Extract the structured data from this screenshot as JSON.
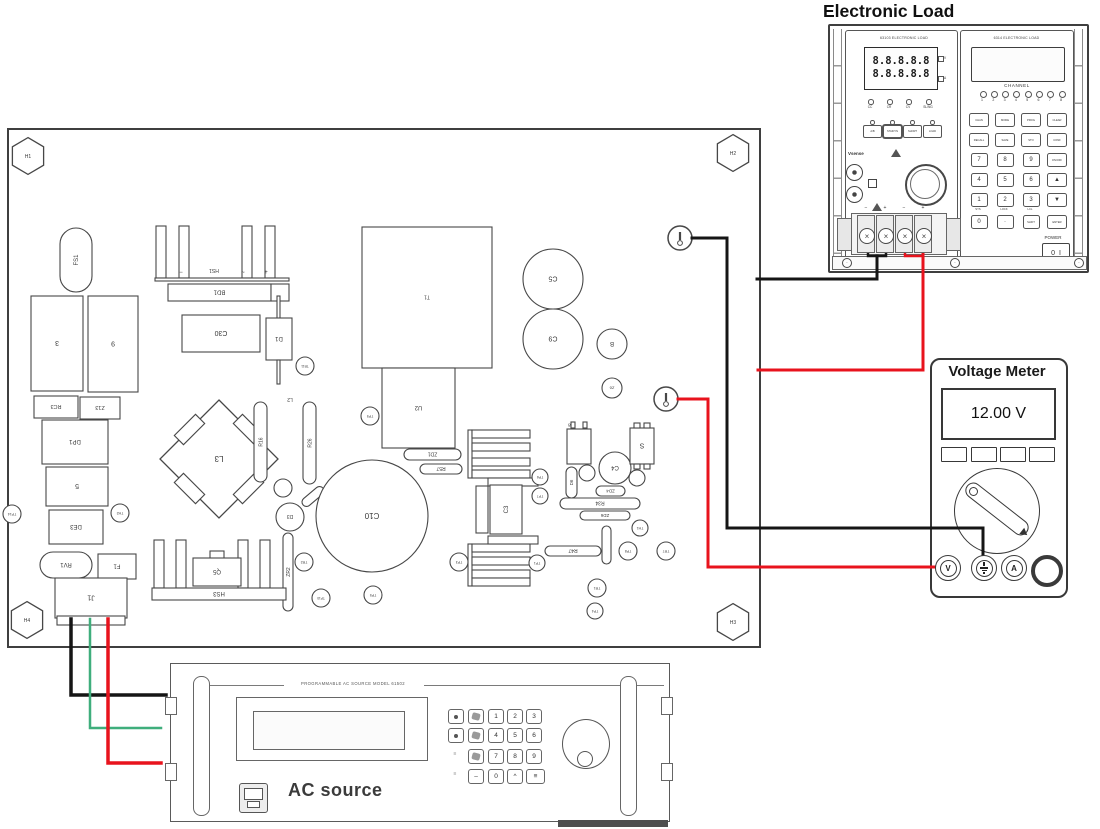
{
  "titles": {
    "electronic_load": "Electronic Load",
    "voltage_meter": "Voltage Meter",
    "ac_source_label": "AC source",
    "ac_source_header": "PROGRAMMABLE AC SOURCE MODEL 61502"
  },
  "load": {
    "left_module_title": "63103 ELECTRONIC LOAD",
    "right_module_title": "6314 ELECTRONIC LOAD",
    "display_rows": [
      "8.8.8.8.8",
      "8.8.8.8.8"
    ],
    "display_units": [
      "V",
      "A"
    ],
    "indicators": [
      "CC",
      "CR",
      "CV",
      "SL/NG"
    ],
    "mode_buttons": [
      "A/B",
      "STA/DYN",
      "SHORT",
      "LOAD"
    ],
    "vsense_label": "Vsense",
    "channel_label": "CHANNEL",
    "channels": [
      "1",
      "2",
      "3",
      "4",
      "5",
      "6",
      "7",
      "8"
    ],
    "keypad": [
      [
        "CHAN",
        "MODE",
        "PROG",
        "CLEAR"
      ],
      [
        "RECALL",
        "SAVE",
        "STO",
        "CONF"
      ],
      [
        "7",
        "8",
        "9",
        "ON/OFF"
      ],
      [
        "4",
        "5",
        "6",
        "▲"
      ],
      [
        "1",
        "2",
        "3",
        "▼"
      ],
      [
        "0",
        "·",
        "SHIFT",
        "ENTER"
      ]
    ],
    "keypad_sublabels": [
      "SYS",
      "LOCK",
      "LCL"
    ],
    "power_label": "POWER",
    "power_switch_off": "0",
    "power_switch_on": "I",
    "terminal_marks": [
      "−",
      "+",
      "−",
      "+"
    ]
  },
  "meter": {
    "reading": "12.00 V",
    "jacks": [
      "V",
      "gnd",
      "A",
      ""
    ]
  },
  "ac": {
    "keypad": [
      [
        "knob",
        "icon",
        "1",
        "2",
        "3"
      ],
      [
        "knob",
        "icon",
        "4",
        "5",
        "6"
      ],
      [
        "mark",
        "fill",
        "7",
        "8",
        "9"
      ],
      [
        "mark",
        "dash",
        "0",
        "caret",
        "wide"
      ]
    ]
  },
  "pcb": {
    "board": {
      "x": 8,
      "y": 129,
      "w": 752,
      "h": 518
    },
    "hexes": [
      {
        "x": 28,
        "y": 156,
        "rad": 18,
        "l": "H1"
      },
      {
        "x": 733,
        "y": 153,
        "rad": 18,
        "l": "H2"
      },
      {
        "x": 733,
        "y": 622,
        "rad": 18,
        "l": "H3"
      },
      {
        "x": 27,
        "y": 620,
        "rad": 18,
        "l": "H4"
      }
    ],
    "components": [
      {
        "t": "pill",
        "x": 60,
        "y": 228,
        "w": 32,
        "h": 64,
        "l": "FS1",
        "r": 270,
        "fs": 6
      },
      {
        "t": "rect",
        "x": 31,
        "y": 296,
        "w": 52,
        "h": 95,
        "l": "3",
        "r": 180,
        "fs": 7
      },
      {
        "t": "rect",
        "x": 88,
        "y": 296,
        "w": 50,
        "h": 96,
        "l": "9",
        "r": 180,
        "fs": 7
      },
      {
        "t": "rect",
        "x": 34,
        "y": 396,
        "w": 44,
        "h": 22,
        "l": "RC3",
        "r": 180,
        "fs": 5.5
      },
      {
        "t": "rect",
        "x": 80,
        "y": 397,
        "w": 40,
        "h": 22,
        "l": "Z13",
        "r": 180,
        "fs": 5.5
      },
      {
        "t": "rect",
        "x": 42,
        "y": 420,
        "w": 66,
        "h": 44,
        "l": "DP1",
        "r": 180,
        "fs": 6
      },
      {
        "t": "rect",
        "x": 46,
        "y": 467,
        "w": 62,
        "h": 39,
        "l": "5",
        "r": 180,
        "fs": 7
      },
      {
        "t": "rect",
        "x": 49,
        "y": 510,
        "w": 54,
        "h": 34,
        "l": "DE3",
        "r": 180,
        "fs": 6
      },
      {
        "t": "circle",
        "x": 12,
        "y": 514,
        "rad": 9,
        "l": "TP14",
        "r": 180,
        "fs": 3.5
      },
      {
        "t": "circle",
        "x": 120,
        "y": 513,
        "rad": 9,
        "l": "TH2",
        "r": 180,
        "fs": 3.5
      },
      {
        "t": "pill",
        "x": 40,
        "y": 552,
        "w": 52,
        "h": 26,
        "l": "RV1",
        "r": 180,
        "fs": 6
      },
      {
        "t": "rect",
        "x": 98,
        "y": 554,
        "w": 38,
        "h": 25,
        "l": "F1",
        "r": 180,
        "fs": 6
      },
      {
        "t": "rect",
        "x": 55,
        "y": 578,
        "w": 72,
        "h": 40,
        "l": "J1",
        "r": 180,
        "fs": 7
      },
      {
        "t": "rect",
        "x": 57,
        "y": 616,
        "w": 68,
        "h": 9
      },
      {
        "t": "finset",
        "x": 152,
        "y": 226,
        "fw": 10,
        "fh": 52,
        "fxs": [
          4,
          27,
          90,
          113
        ]
      },
      {
        "t": "rect",
        "x": 155,
        "y": 278,
        "w": 134,
        "h": 3
      },
      {
        "t": "text",
        "x": 181,
        "y": 272,
        "l": "−",
        "fs": 6
      },
      {
        "t": "text",
        "x": 214,
        "y": 271,
        "l": "HS1",
        "r": 180,
        "fs": 5
      },
      {
        "t": "text",
        "x": 243,
        "y": 272,
        "l": "~",
        "fs": 6
      },
      {
        "t": "text",
        "x": 266,
        "y": 272,
        "l": "+",
        "fs": 6
      },
      {
        "t": "rect",
        "x": 168,
        "y": 284,
        "w": 103,
        "h": 17,
        "l": "BD1",
        "r": 180,
        "fs": 6
      },
      {
        "t": "rect",
        "x": 271,
        "y": 284,
        "w": 18,
        "h": 17
      },
      {
        "t": "rect",
        "x": 182,
        "y": 315,
        "w": 78,
        "h": 37,
        "l": "C30",
        "r": 180,
        "fs": 7
      },
      {
        "t": "rect",
        "x": 277,
        "y": 296,
        "w": 3,
        "h": 24
      },
      {
        "t": "rect",
        "x": 266,
        "y": 318,
        "w": 26,
        "h": 42,
        "l": "D1",
        "r": 180,
        "fs": 6
      },
      {
        "t": "rect",
        "x": 277,
        "y": 360,
        "w": 3,
        "h": 24
      },
      {
        "t": "circle",
        "x": 305,
        "y": 366,
        "rad": 9,
        "l": "TR11",
        "r": 180,
        "fs": 3.2
      },
      {
        "t": "rect",
        "x": 362,
        "y": 227,
        "w": 130,
        "h": 141,
        "l": "T1",
        "r": 180,
        "fs": 5
      },
      {
        "t": "rect",
        "x": 382,
        "y": 368,
        "w": 73,
        "h": 80,
        "l": "U2",
        "r": 180,
        "fs": 6
      },
      {
        "t": "circle",
        "x": 553,
        "y": 279,
        "rad": 30,
        "l": "C5",
        "r": 180,
        "fs": 7
      },
      {
        "t": "circle",
        "x": 553,
        "y": 339,
        "rad": 30,
        "l": "C9",
        "r": 180,
        "fs": 7
      },
      {
        "t": "circle",
        "x": 612,
        "y": 344,
        "rad": 15,
        "l": "B",
        "r": 180,
        "fs": 6
      },
      {
        "t": "circle",
        "x": 612,
        "y": 388,
        "rad": 10,
        "l": "Z6",
        "r": 180,
        "fs": 4
      },
      {
        "t": "tp",
        "x": 680,
        "y": 238,
        "rad": 12
      },
      {
        "t": "tp",
        "x": 666,
        "y": 399,
        "rad": 12
      },
      {
        "t": "xf",
        "x": 219,
        "y": 459,
        "s": 118,
        "l": "L3",
        "r": 180,
        "fs": 8
      },
      {
        "t": "pill",
        "x": 254,
        "y": 402,
        "w": 13,
        "h": 80,
        "l": "R16",
        "r": 270,
        "fs": 5
      },
      {
        "t": "pill",
        "x": 303,
        "y": 402,
        "w": 13,
        "h": 82,
        "l": "R26",
        "r": 270,
        "fs": 5
      },
      {
        "t": "text",
        "x": 290,
        "y": 400,
        "l": "L2",
        "r": 180,
        "fs": 5
      },
      {
        "t": "circle",
        "x": 283,
        "y": 488,
        "rad": 9
      },
      {
        "t": "circle",
        "x": 290,
        "y": 517,
        "rad": 14,
        "l": "D3",
        "r": 180,
        "fs": 5
      },
      {
        "t": "pill",
        "x": 300,
        "y": 492,
        "w": 26,
        "h": 9,
        "a": -40
      },
      {
        "t": "circle",
        "x": 372,
        "y": 516,
        "rad": 56,
        "l": "C10",
        "r": 180,
        "fs": 8
      },
      {
        "t": "pill",
        "x": 404,
        "y": 449,
        "w": 57,
        "h": 11,
        "l": "ZD1",
        "r": 180,
        "fs": 5
      },
      {
        "t": "pill",
        "x": 420,
        "y": 464,
        "w": 42,
        "h": 10,
        "l": "R57",
        "r": 180,
        "fs": 5
      },
      {
        "t": "circle",
        "x": 370,
        "y": 416,
        "rad": 9,
        "l": "TP9",
        "r": 180,
        "fs": 3.5
      },
      {
        "t": "finseth",
        "x": 468,
        "y": 430,
        "fw": 58,
        "fh": 8,
        "fys": [
          0,
          13,
          28,
          40
        ]
      },
      {
        "t": "finseth",
        "x": 468,
        "y": 544,
        "fw": 58,
        "fh": 8,
        "fys": [
          0,
          13,
          26,
          34
        ]
      },
      {
        "t": "rect",
        "x": 488,
        "y": 478,
        "w": 50,
        "h": 8
      },
      {
        "t": "rect",
        "x": 488,
        "y": 536,
        "w": 50,
        "h": 8
      },
      {
        "t": "rect",
        "x": 476,
        "y": 486,
        "w": 12,
        "h": 47
      },
      {
        "t": "rect",
        "x": 490,
        "y": 485,
        "w": 32,
        "h": 49,
        "l": "C3",
        "r": 270,
        "fs": 6
      },
      {
        "t": "rect",
        "x": 567,
        "y": 429,
        "w": 24,
        "h": 35
      },
      {
        "t": "text",
        "x": 571,
        "y": 425,
        "l": "C8",
        "r": 180,
        "fs": 4.5
      },
      {
        "t": "rect",
        "x": 571,
        "y": 422,
        "w": 4,
        "h": 6
      },
      {
        "t": "rect",
        "x": 583,
        "y": 422,
        "w": 4,
        "h": 6
      },
      {
        "t": "pill",
        "x": 566,
        "y": 467,
        "w": 11,
        "h": 31,
        "l": "D6",
        "r": 270,
        "fs": 4.5
      },
      {
        "t": "circle",
        "x": 615,
        "y": 468,
        "rad": 16,
        "l": "C4",
        "r": 180,
        "fs": 6
      },
      {
        "t": "circle",
        "x": 587,
        "y": 473,
        "rad": 8
      },
      {
        "t": "circle",
        "x": 637,
        "y": 478,
        "rad": 8
      },
      {
        "t": "rect",
        "x": 630,
        "y": 428,
        "w": 24,
        "h": 36,
        "l": "S",
        "r": 180,
        "fs": 7
      },
      {
        "t": "rect",
        "x": 634,
        "y": 423,
        "w": 6,
        "h": 5
      },
      {
        "t": "rect",
        "x": 644,
        "y": 423,
        "w": 6,
        "h": 5
      },
      {
        "t": "rect",
        "x": 634,
        "y": 464,
        "w": 6,
        "h": 5
      },
      {
        "t": "rect",
        "x": 644,
        "y": 464,
        "w": 6,
        "h": 5
      },
      {
        "t": "pill",
        "x": 596,
        "y": 486,
        "w": 29,
        "h": 10,
        "l": "ZD4",
        "r": 180,
        "fs": 4.5
      },
      {
        "t": "pill",
        "x": 560,
        "y": 498,
        "w": 80,
        "h": 11,
        "l": "R34",
        "r": 180,
        "fs": 5
      },
      {
        "t": "pill",
        "x": 580,
        "y": 511,
        "w": 50,
        "h": 9,
        "l": "ZD6",
        "r": 180,
        "fs": 4.5
      },
      {
        "t": "circle",
        "x": 640,
        "y": 528,
        "rad": 8,
        "l": "TH1",
        "r": 180,
        "fs": 3.5
      },
      {
        "t": "circle",
        "x": 628,
        "y": 551,
        "rad": 9,
        "l": "TP8",
        "r": 180,
        "fs": 3.5
      },
      {
        "t": "circle",
        "x": 666,
        "y": 551,
        "rad": 9,
        "l": "TR7",
        "r": 180,
        "fs": 3.5
      },
      {
        "t": "circle",
        "x": 597,
        "y": 588,
        "rad": 9,
        "l": "TR1",
        "r": 180,
        "fs": 3.5
      },
      {
        "t": "circle",
        "x": 595,
        "y": 611,
        "rad": 8,
        "l": "TP4",
        "r": 180,
        "fs": 3.5
      },
      {
        "t": "pill",
        "x": 545,
        "y": 546,
        "w": 56,
        "h": 10,
        "l": "R47",
        "r": 180,
        "fs": 5
      },
      {
        "t": "pill",
        "x": 602,
        "y": 526,
        "w": 9,
        "h": 38
      },
      {
        "t": "pill",
        "x": 283,
        "y": 533,
        "w": 10,
        "h": 78,
        "l": "ZR2",
        "r": 270,
        "fs": 5
      },
      {
        "t": "finset",
        "x": 150,
        "y": 540,
        "fw": 10,
        "fh": 48,
        "fxs": [
          4,
          26,
          88,
          110
        ]
      },
      {
        "t": "rect",
        "x": 152,
        "y": 588,
        "w": 134,
        "h": 12,
        "l": "HS3",
        "r": 180,
        "fs": 6
      },
      {
        "t": "rect",
        "x": 210,
        "y": 551,
        "w": 14,
        "h": 8
      },
      {
        "t": "rect",
        "x": 193,
        "y": 558,
        "w": 48,
        "h": 28,
        "l": "Q5",
        "r": 180,
        "fs": 6
      },
      {
        "t": "circle",
        "x": 304,
        "y": 562,
        "rad": 9,
        "l": "TR2",
        "r": 180,
        "fs": 3.5
      },
      {
        "t": "circle",
        "x": 373,
        "y": 595,
        "rad": 9,
        "l": "TP5",
        "r": 180,
        "fs": 3.5
      },
      {
        "t": "circle",
        "x": 321,
        "y": 598,
        "rad": 9,
        "l": "TP10",
        "r": 180,
        "fs": 3.2
      },
      {
        "t": "circle",
        "x": 459,
        "y": 562,
        "rad": 9,
        "l": "TP3",
        "r": 180,
        "fs": 3.5
      },
      {
        "t": "circle",
        "x": 540,
        "y": 477,
        "rad": 8,
        "l": "TP6",
        "r": 180,
        "fs": 3.5
      },
      {
        "t": "circle",
        "x": 540,
        "y": 496,
        "rad": 8,
        "l": "TP7",
        "r": 180,
        "fs": 3.5
      },
      {
        "t": "circle",
        "x": 537,
        "y": 563,
        "rad": 8,
        "l": "TP1",
        "r": 180,
        "fs": 3.5
      }
    ]
  },
  "wires": [
    {
      "name": "wire-load-neg-loop",
      "color": "#151515",
      "w": 2.5,
      "pts": [
        [
          868,
          243
        ],
        [
          868,
          256
        ],
        [
          886,
          256
        ],
        [
          886,
          243
        ]
      ]
    },
    {
      "name": "wire-load-neg",
      "color": "#151515",
      "w": 3,
      "pts": [
        [
          877,
          256
        ],
        [
          877,
          279
        ],
        [
          757,
          279
        ]
      ]
    },
    {
      "name": "wire-load-pos-loop",
      "color": "#e8131d",
      "w": 2.5,
      "pts": [
        [
          905,
          243
        ],
        [
          905,
          256
        ],
        [
          923,
          256
        ]
      ]
    },
    {
      "name": "wire-load-pos",
      "color": "#e8131d",
      "w": 3,
      "pts": [
        [
          923,
          243
        ],
        [
          923,
          370
        ],
        [
          758,
          370
        ]
      ]
    },
    {
      "name": "wire-meter-black",
      "color": "#151515",
      "w": 3,
      "pts": [
        [
          692,
          238
        ],
        [
          727,
          238
        ],
        [
          727,
          528
        ],
        [
          983,
          528
        ],
        [
          983,
          557
        ]
      ]
    },
    {
      "name": "wire-meter-red",
      "color": "#e8131d",
      "w": 3,
      "pts": [
        [
          678,
          399
        ],
        [
          708,
          399
        ],
        [
          708,
          567
        ],
        [
          934,
          567
        ]
      ]
    },
    {
      "name": "wire-ac-black",
      "color": "#151515",
      "w": 3.5,
      "pts": [
        [
          71,
          619
        ],
        [
          71,
          695
        ],
        [
          166,
          695
        ]
      ]
    },
    {
      "name": "wire-ac-green",
      "color": "#3fae7c",
      "w": 2.5,
      "pts": [
        [
          90,
          619
        ],
        [
          90,
          728
        ],
        [
          161,
          728
        ]
      ]
    },
    {
      "name": "wire-ac-red",
      "color": "#e8131d",
      "w": 3.5,
      "pts": [
        [
          108,
          619
        ],
        [
          108,
          763
        ],
        [
          161,
          763
        ]
      ]
    }
  ]
}
